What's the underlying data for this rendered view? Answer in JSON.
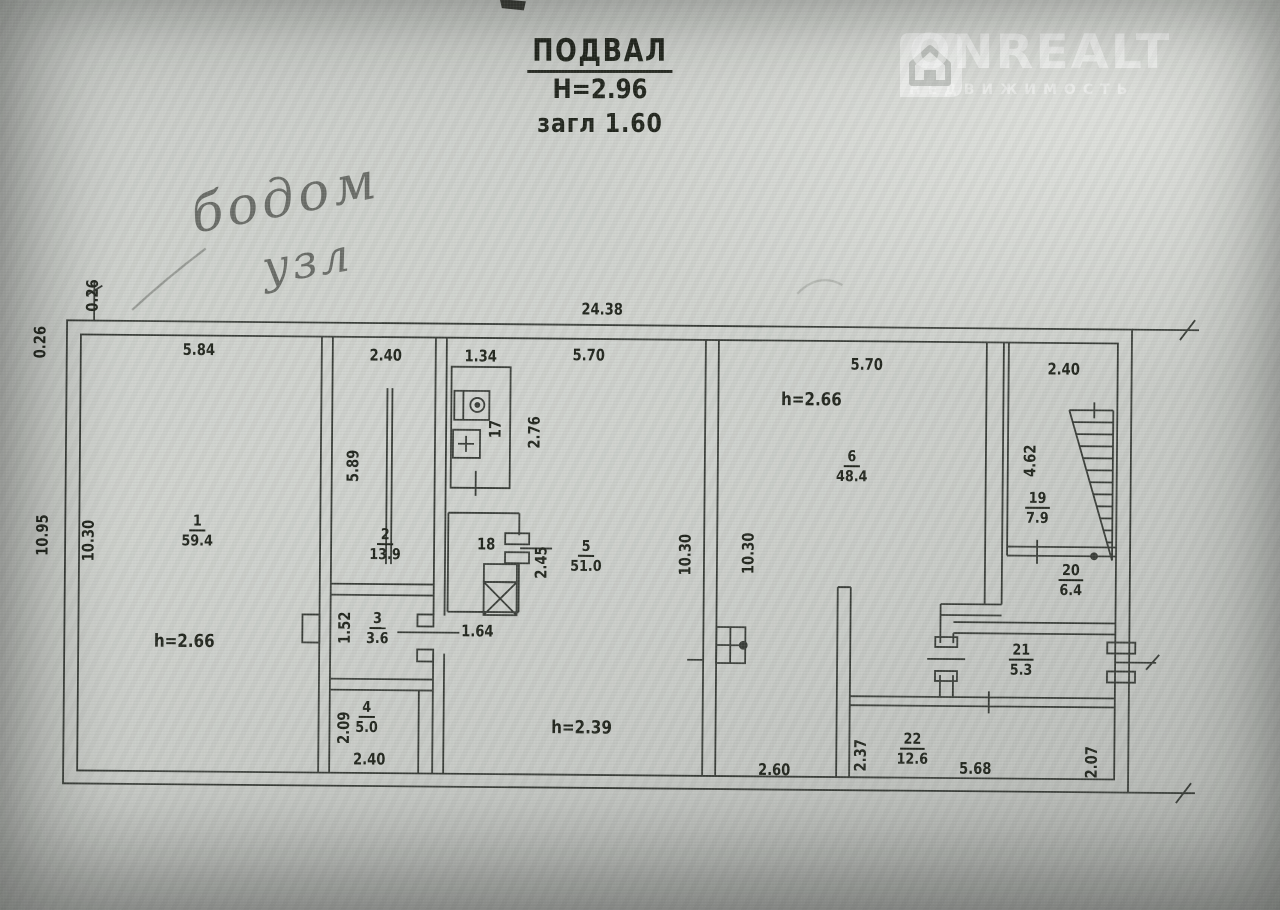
{
  "header": {
    "title": "ПОДВАЛ",
    "height_note": "Н=2.96",
    "depth_note": "загл 1.60"
  },
  "watermark": {
    "brand": "ONREALT",
    "tagline": "НЕДВИЖИМОСТЬ"
  },
  "annotations": {
    "handwriting_line1": "бодом",
    "handwriting_line2": "узл"
  },
  "plan": {
    "overall_dims": {
      "top_width": "24.38",
      "left_outer": "10.95",
      "left_inner": "10.30",
      "top_offset_outer": "0.26",
      "top_offset_inner": "0.26"
    },
    "rooms": {
      "r1": {
        "number": "1",
        "area": "59.4",
        "width": "5.84",
        "height_note": "h=2.66"
      },
      "r2": {
        "number": "2",
        "area": "13.9",
        "width": "2.40",
        "depth": "5.89"
      },
      "r3": {
        "number": "3",
        "area": "3.6",
        "depth": "1.52"
      },
      "r4": {
        "number": "4",
        "area": "5.0",
        "depth": "2.09",
        "width": "2.40"
      },
      "r5": {
        "number": "5",
        "area": "51.0",
        "width": "5.70",
        "right_height": "10.30",
        "height_note": "h=2.39",
        "door_width": "1.64"
      },
      "r6": {
        "number": "6",
        "area": "48.4",
        "width": "5.70",
        "left_height": "10.30",
        "height_note": "h=2.66"
      },
      "r17": {
        "number": "17",
        "width": "1.34",
        "depth": "2.76"
      },
      "r18": {
        "number": "18",
        "depth": "2.45"
      },
      "r19": {
        "number": "19",
        "area": "7.9",
        "width": "2.40",
        "depth": "4.62"
      },
      "r20": {
        "number": "20",
        "area": "6.4"
      },
      "r21": {
        "number": "21",
        "area": "5.3"
      },
      "r22": {
        "number": "22",
        "area": "12.6",
        "left_height": "2.37",
        "bottom_width": "5.68",
        "right_height": "2.07"
      },
      "corridor": {
        "width": "2.60"
      }
    }
  }
}
